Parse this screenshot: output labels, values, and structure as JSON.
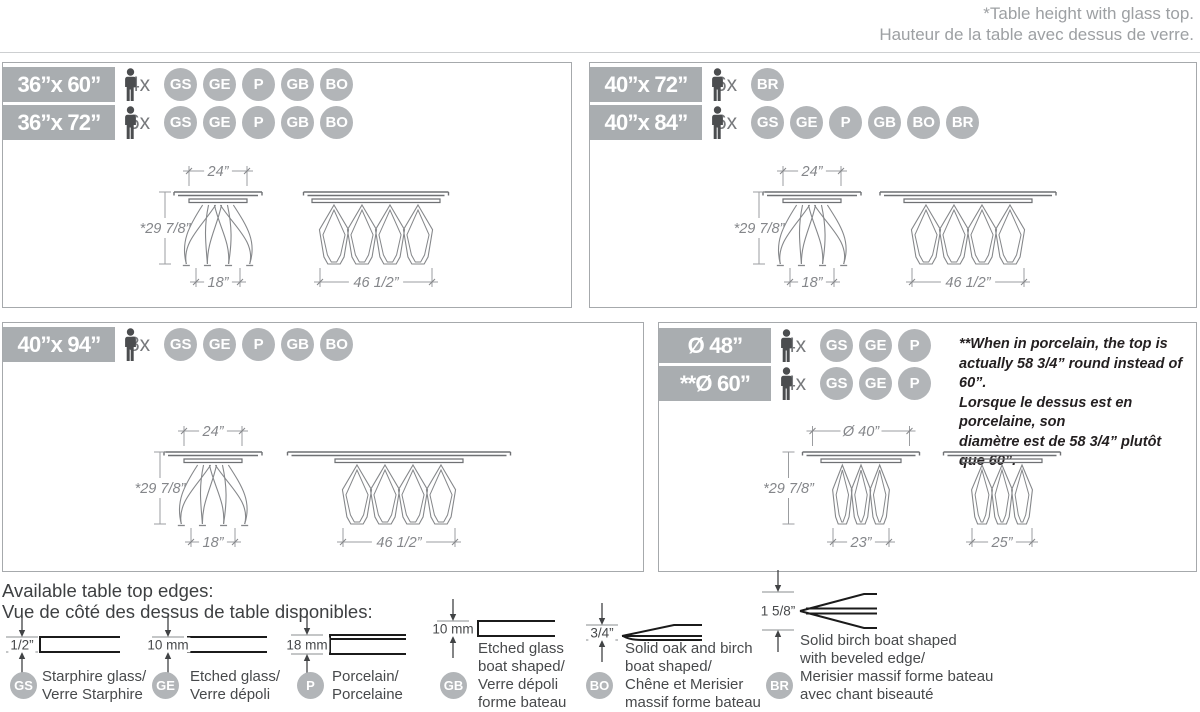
{
  "colors": {
    "bar_gray": "#a9adb0",
    "badge_gray": "#b2b5b8",
    "note_dark": "#231f20",
    "line_gray": "#9b9da0"
  },
  "header": {
    "line_en": "*Table height with glass top.",
    "line_fr": "Hauteur de la table avec dessus de verre."
  },
  "panels": [
    {
      "rows": [
        {
          "size": "36”x 60”",
          "seats": "4x",
          "badges": [
            "GS",
            "GE",
            "P",
            "GB",
            "BO"
          ]
        },
        {
          "size": "36”x 72”",
          "seats": "6x",
          "badges": [
            "GS",
            "GE",
            "P",
            "GB",
            "BO"
          ]
        }
      ],
      "dims": {
        "top": "24”",
        "height": "*29 7/8”",
        "base_small": "18”",
        "base_large": "46 1/2”"
      }
    },
    {
      "rows": [
        {
          "size": "40”x 72”",
          "seats": "6x",
          "badges": [
            "BR"
          ]
        },
        {
          "size": "40”x 84”",
          "seats": "6x",
          "badges": [
            "GS",
            "GE",
            "P",
            "GB",
            "BO",
            "BR"
          ]
        }
      ],
      "dims": {
        "top": "24”",
        "height": "*29 7/8”",
        "base_small": "18”",
        "base_large": "46 1/2”"
      }
    },
    {
      "rows": [
        {
          "size": "40”x 94”",
          "seats": "8x",
          "badges": [
            "GS",
            "GE",
            "P",
            "GB",
            "BO"
          ]
        }
      ],
      "dims": {
        "top": "24”",
        "height": "*29 7/8”",
        "base_small": "18”",
        "base_large": "46 1/2”"
      }
    },
    {
      "rows": [
        {
          "size": "Ø 48”",
          "seats": "4x",
          "badges": [
            "GS",
            "GE",
            "P"
          ]
        },
        {
          "size": "**Ø 60”",
          "seats": "4x",
          "badges": [
            "GS",
            "GE",
            "P"
          ]
        }
      ],
      "dims": {
        "top": "Ø 40”",
        "height": "*29 7/8”",
        "base_small": "23”",
        "base_large": "25”"
      },
      "note_lines": [
        "**When in porcelain, the top is",
        "actually 58 3/4” round instead of 60”.",
        "Lorsque le dessus est en porcelaine, son",
        "diamètre est de 58 3/4” plutôt que 60”."
      ]
    }
  ],
  "edges": {
    "title_en": "Available table top edges:",
    "title_fr": "Vue de côté des dessus de table disponibles:",
    "items": [
      {
        "dim": "1/2”",
        "code": "GS",
        "lines": [
          "Starphire glass/",
          "Verre Starphire"
        ]
      },
      {
        "dim": "10 mm",
        "code": "GE",
        "lines": [
          "Etched glass/",
          "Verre dépoli"
        ]
      },
      {
        "dim": "18 mm",
        "code": "P",
        "lines": [
          "Porcelain/",
          "Porcelaine"
        ]
      },
      {
        "dim": "10 mm",
        "code": "GB",
        "lines": [
          "Etched glass",
          "boat shaped/",
          "Verre dépoli",
          "forme bateau"
        ]
      },
      {
        "dim": "3/4”",
        "code": "BO",
        "lines": [
          "Solid oak and birch",
          "boat shaped/",
          "Chêne et Merisier",
          "massif forme bateau"
        ]
      },
      {
        "dim": "1 5/8”",
        "code": "BR",
        "lines": [
          "Solid birch boat shaped",
          "with beveled edge/",
          "Merisier massif forme bateau",
          "avec chant biseauté"
        ]
      }
    ]
  }
}
